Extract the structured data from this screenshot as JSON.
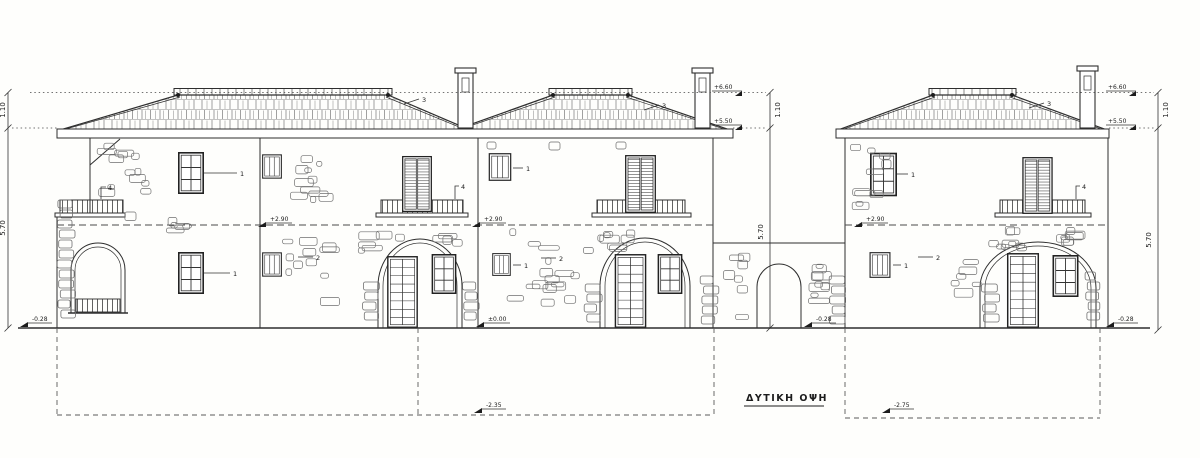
{
  "drawing": {
    "title": "ΔΥΤΙΚΗ ΟΨΗ"
  },
  "dimensions": {
    "left": {
      "upper": "1.10",
      "lower": "5.70"
    },
    "middle": {
      "upper": "1.10",
      "lower": "5.70"
    },
    "right": {
      "upper": "1.10",
      "lower": "5.70"
    }
  },
  "levels": {
    "ridge_middle": "+6.60",
    "eave_middle": "+5.50",
    "ridge_right": "+6.60",
    "eave_right": "+5.50",
    "upper_floor_left": "+2.90",
    "upper_floor_middle": "+2.90",
    "upper_floor_right": "+2.90",
    "ground_zero": "±0.00",
    "ground_left": "-0.28",
    "ground_court": "-0.28",
    "ground_right": "-0.28",
    "foundation_center": "-2.35",
    "foundation_right": "-2.75"
  },
  "key_notes": {
    "window": "1",
    "wall": "2",
    "roof": "3",
    "railing": "4"
  },
  "colors": {
    "ink": "#2e2e2e",
    "paper": "#fefefc"
  }
}
